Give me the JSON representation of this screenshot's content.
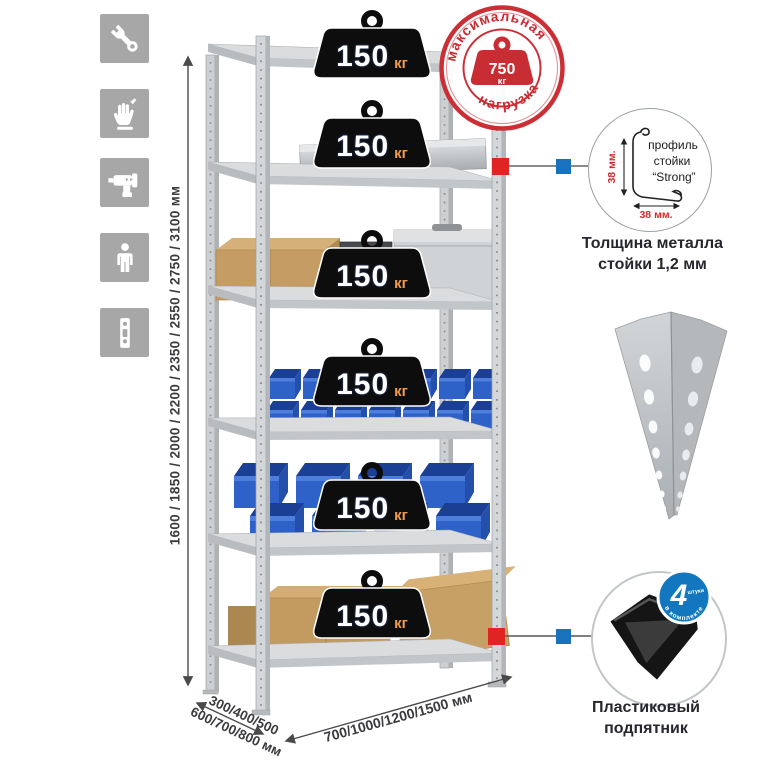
{
  "title": "Металлический стеллаж — инфографика",
  "sidebar_icons": [
    {
      "name": "wrench-icon"
    },
    {
      "name": "gloves-icon"
    },
    {
      "name": "drill-icon"
    },
    {
      "name": "person-icon"
    },
    {
      "name": "level-icon"
    }
  ],
  "dimensions": {
    "height": "1600 / 1850 / 2000 / 2200 / 2350 / 2550 / 2750 / 3100 мм",
    "depth_line1": "300/400/500",
    "depth_line2": "600/700/800 мм",
    "width": "700/1000/1200/1500 мм"
  },
  "shelves": [
    {
      "load": "150",
      "unit": "кг"
    },
    {
      "load": "150",
      "unit": "кг"
    },
    {
      "load": "150",
      "unit": "кг"
    },
    {
      "load": "150",
      "unit": "кг"
    },
    {
      "load": "150",
      "unit": "кг"
    },
    {
      "load": "150",
      "unit": "кг"
    }
  ],
  "stamp": {
    "arc_top": "максимальная",
    "arc_bottom": "нагрузка",
    "value": "750",
    "unit": "кг"
  },
  "profile_detail": {
    "line1": "профиль",
    "line2": "стойки",
    "line3": "“Strong”",
    "dim_vertical": "38 мм.",
    "dim_horizontal": "38 мм.",
    "caption_line1": "Толщина металла",
    "caption_line2": "стойки 1,2 мм"
  },
  "foot_detail": {
    "badge_value": "4",
    "badge_small": "штуки",
    "badge_arc": "в комплекте",
    "caption_line1": "Пластиковый",
    "caption_line2": "подпятник"
  },
  "colors": {
    "accent_red": "#d22b2f",
    "connector_blue": "#1873bc",
    "bin_blue": "#2f62c8",
    "metal_gray": "#d2d5d7",
    "icon_tile_gray": "#a7a7a7",
    "text_dark": "#3b3b40"
  }
}
